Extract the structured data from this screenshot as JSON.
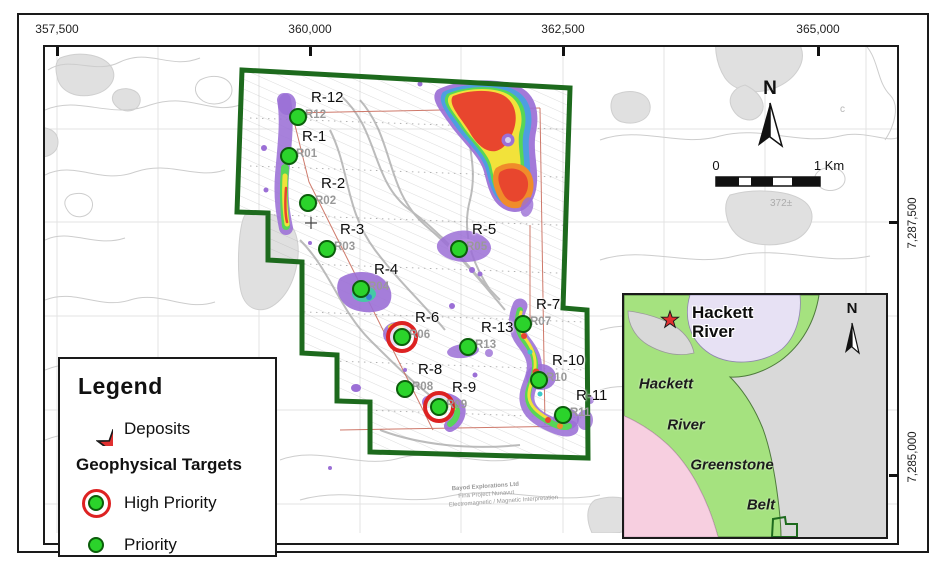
{
  "map": {
    "top_axis": {
      "labels": [
        "357,500",
        "360,000",
        "362,500",
        "365,000"
      ]
    },
    "right_axis": {
      "labels": [
        "7,287,500",
        "7,285,000"
      ]
    },
    "north_label": "N",
    "scale_bar": {
      "start": "0",
      "end": "1 Km"
    },
    "elevation_label": "372±",
    "contour_letter": "c",
    "credits": {
      "line1": "Bayod Explorations Ltd",
      "line2": "Fina Project Nunavut",
      "line3": "Electromagnetic / Magnetic Interpretation"
    },
    "targets": [
      {
        "label": "R-12",
        "code": "R12",
        "x": 298,
        "y": 117,
        "priority": "normal"
      },
      {
        "label": "R-1",
        "code": "R01",
        "x": 289,
        "y": 156,
        "priority": "normal"
      },
      {
        "label": "R-2",
        "code": "R02",
        "x": 308,
        "y": 203,
        "priority": "normal"
      },
      {
        "label": "R-3",
        "code": "R03",
        "x": 327,
        "y": 249,
        "priority": "normal"
      },
      {
        "label": "R-4",
        "code": "R04",
        "x": 361,
        "y": 289,
        "priority": "normal"
      },
      {
        "label": "R-5",
        "code": "R05",
        "x": 459,
        "y": 249,
        "priority": "normal"
      },
      {
        "label": "R-6",
        "code": "R06",
        "x": 402,
        "y": 337,
        "priority": "high"
      },
      {
        "label": "R-7",
        "code": "R07",
        "x": 523,
        "y": 324,
        "priority": "normal"
      },
      {
        "label": "R-13",
        "code": "R13",
        "x": 468,
        "y": 347,
        "priority": "normal"
      },
      {
        "label": "R-8",
        "code": "R08",
        "x": 405,
        "y": 389,
        "priority": "normal"
      },
      {
        "label": "R-9",
        "code": "R09",
        "x": 439,
        "y": 407,
        "priority": "high"
      },
      {
        "label": "R-10",
        "code": "R10",
        "x": 539,
        "y": 380,
        "priority": "normal"
      },
      {
        "label": "R-11",
        "code": "R11",
        "x": 563,
        "y": 415,
        "priority": "normal"
      }
    ]
  },
  "legend": {
    "title": "Legend",
    "deposits_label": "Deposits",
    "section_title": "Geophysical Targets",
    "high_priority_label": "High Priority",
    "priority_label": "Priority"
  },
  "inset": {
    "star_label_line1": "Hackett",
    "star_label_line2": "River",
    "band_labels": [
      "Hackett",
      "River",
      "Greenstone",
      "Belt"
    ],
    "north_label": "N"
  },
  "colors": {
    "claim_boundary": "#1d6a1d",
    "target_green": "#2bd32b",
    "high_priority_red": "#dd2222",
    "deposit_star_red": "#e03030",
    "anomaly_purple": "#9b6fd6",
    "inset_greenstone": "#a5e27f",
    "inset_pink": "#f7cfe0",
    "inset_lavender": "#e7e1f4"
  }
}
